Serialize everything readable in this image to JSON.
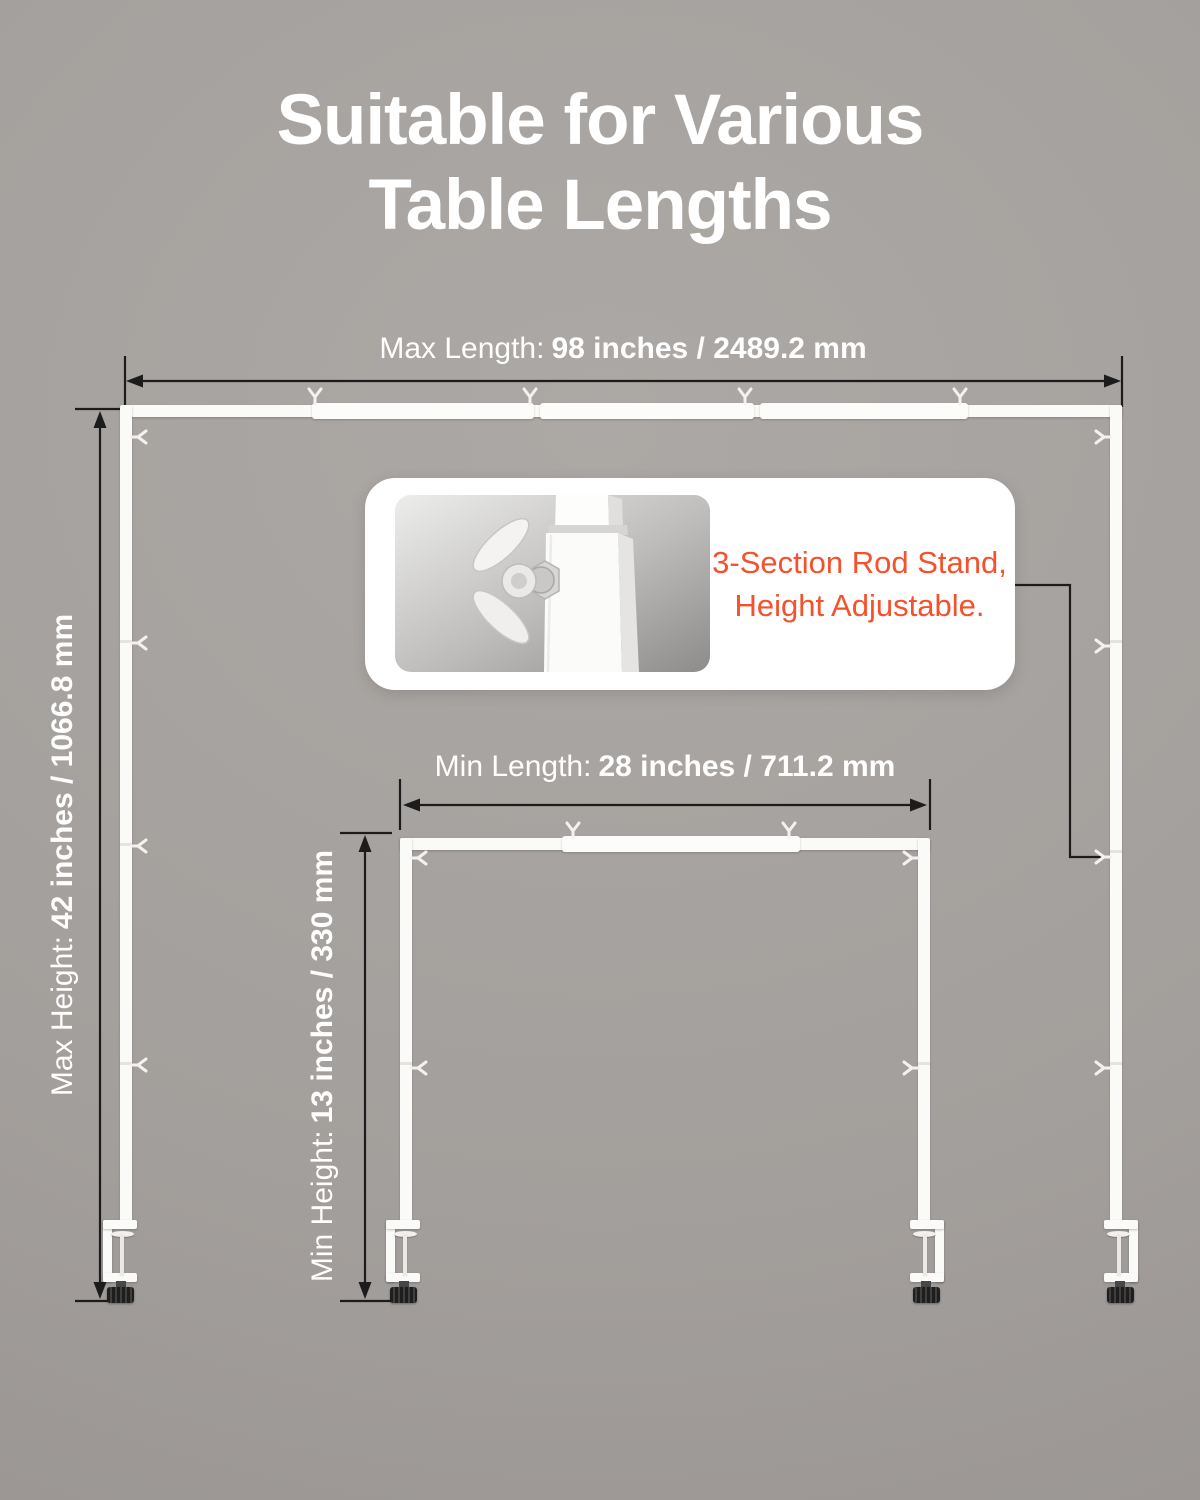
{
  "title": {
    "line1": "Suitable for Various",
    "line2": "Table Lengths"
  },
  "annotations": {
    "max_length": {
      "label": "Max Length:",
      "value": "98 inches / 2489.2 mm"
    },
    "max_height": {
      "label": "Max Height:",
      "value": "42 inches / 1066.8 mm"
    },
    "min_length": {
      "label": "Min Length:",
      "value": "28 inches / 711.2 mm"
    },
    "min_height": {
      "label": "Min Height:",
      "value": "13 inches / 330 mm"
    }
  },
  "callout": {
    "text_line1": "3-Section Rod Stand,",
    "text_line2": "Height Adjustable.",
    "image_subject": "wing nut on square rod joint"
  },
  "colors": {
    "accent": "#F4512C",
    "bg_center": "#ACA8A5",
    "bg_edge": "#979290",
    "annotation_line": "#1C1C1C",
    "rod_white": "#FAFAF9",
    "knob_black": "#232323",
    "title_text": "#FFFFFF"
  },
  "icons": {
    "rod_clip": "fork-clip-icon",
    "wing_nut": "wing-nut-icon",
    "dimension_arrow": "arrow-line-icon"
  }
}
